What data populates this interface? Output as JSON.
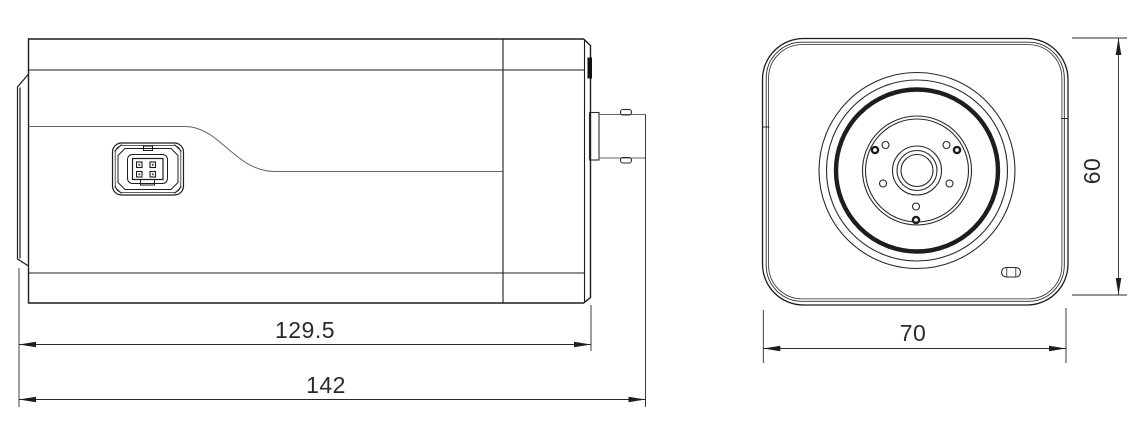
{
  "drawing": {
    "kind": "technical-dimension-drawing",
    "views": [
      {
        "name": "side-view",
        "dimensions": [
          {
            "value": "129.5"
          },
          {
            "value": "142"
          }
        ]
      },
      {
        "name": "front-view",
        "dimensions": [
          {
            "value": "70"
          },
          {
            "value": "60"
          }
        ]
      }
    ],
    "colors": {
      "line": "#1d1d1d",
      "line_soft": "#666666",
      "text": "#2b2b2b",
      "background": "#ffffff"
    }
  }
}
